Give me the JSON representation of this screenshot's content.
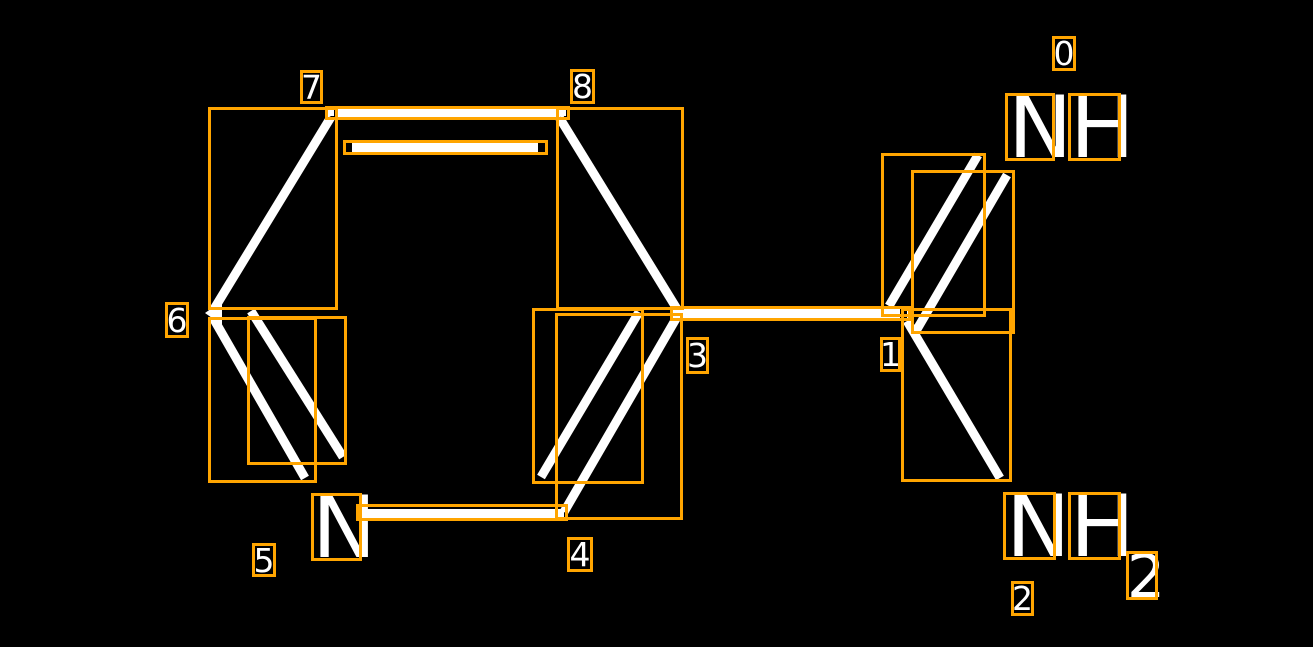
{
  "scene": {
    "description": "Chemical structure annotation view: pyridine ring with carboximidamide group, white bonds on black, orange detection bounding boxes with white index labels",
    "width": 1313,
    "height": 647,
    "background": "#000000"
  },
  "colors": {
    "annotation_box": "#FFA500",
    "bond": "#FFFFFF",
    "label_text": "#FFFFFF"
  },
  "molecule": {
    "ring_n": "N",
    "imine_n": "N",
    "imine_h": "H",
    "amine_n": "N",
    "amine_h": "H",
    "amine_subscript": "2"
  },
  "annotations": {
    "labels": [
      {
        "text": "0",
        "x": 1052,
        "y": 36,
        "w": 24,
        "h": 35
      },
      {
        "text": "1",
        "x": 880,
        "y": 337,
        "w": 21,
        "h": 35
      },
      {
        "text": "2",
        "x": 1011,
        "y": 581,
        "w": 23,
        "h": 35
      },
      {
        "text": "3",
        "x": 686,
        "y": 337,
        "w": 23,
        "h": 37
      },
      {
        "text": "4",
        "x": 567,
        "y": 537,
        "w": 26,
        "h": 35
      },
      {
        "text": "5",
        "x": 252,
        "y": 543,
        "w": 24,
        "h": 34
      },
      {
        "text": "6",
        "x": 165,
        "y": 302,
        "w": 24,
        "h": 36
      },
      {
        "text": "7",
        "x": 300,
        "y": 70,
        "w": 23,
        "h": 34
      },
      {
        "text": "8",
        "x": 570,
        "y": 69,
        "w": 25,
        "h": 35
      }
    ],
    "boxes": [
      {
        "name": "bond-6-7",
        "x": 208,
        "y": 107,
        "w": 130,
        "h": 203
      },
      {
        "name": "bond-7-8-outer",
        "x": 325,
        "y": 106,
        "w": 245,
        "h": 14
      },
      {
        "name": "bond-7-8-inner",
        "x": 343,
        "y": 140,
        "w": 205,
        "h": 15
      },
      {
        "name": "bond-8-3",
        "x": 556,
        "y": 107,
        "w": 128,
        "h": 203
      },
      {
        "name": "bond-5-6-outer",
        "x": 208,
        "y": 317,
        "w": 109,
        "h": 166
      },
      {
        "name": "bond-5-6-inner",
        "x": 247,
        "y": 316,
        "w": 100,
        "h": 149
      },
      {
        "name": "bond-3-4-outer",
        "x": 555,
        "y": 313,
        "w": 128,
        "h": 207
      },
      {
        "name": "bond-3-4-inner",
        "x": 532,
        "y": 308,
        "w": 112,
        "h": 176
      },
      {
        "name": "bond-4-5",
        "x": 356,
        "y": 504,
        "w": 212,
        "h": 17
      },
      {
        "name": "bond-3-1",
        "x": 670,
        "y": 306,
        "w": 241,
        "h": 15
      },
      {
        "name": "bond-1-0-outer",
        "x": 881,
        "y": 153,
        "w": 105,
        "h": 164
      },
      {
        "name": "bond-1-0-inner",
        "x": 911,
        "y": 170,
        "w": 104,
        "h": 164
      },
      {
        "name": "bond-1-2",
        "x": 901,
        "y": 308,
        "w": 111,
        "h": 174
      },
      {
        "name": "atom-5-N",
        "x": 311,
        "y": 493,
        "w": 51,
        "h": 68
      },
      {
        "name": "atom-0-N",
        "x": 1005,
        "y": 93,
        "w": 50,
        "h": 68
      },
      {
        "name": "atom-0-H",
        "x": 1068,
        "y": 93,
        "w": 53,
        "h": 68
      },
      {
        "name": "atom-2-N",
        "x": 1003,
        "y": 492,
        "w": 53,
        "h": 68
      },
      {
        "name": "atom-2-H",
        "x": 1068,
        "y": 492,
        "w": 53,
        "h": 68
      },
      {
        "name": "atom-2-subscript",
        "x": 1126,
        "y": 551,
        "w": 32,
        "h": 49
      }
    ]
  }
}
